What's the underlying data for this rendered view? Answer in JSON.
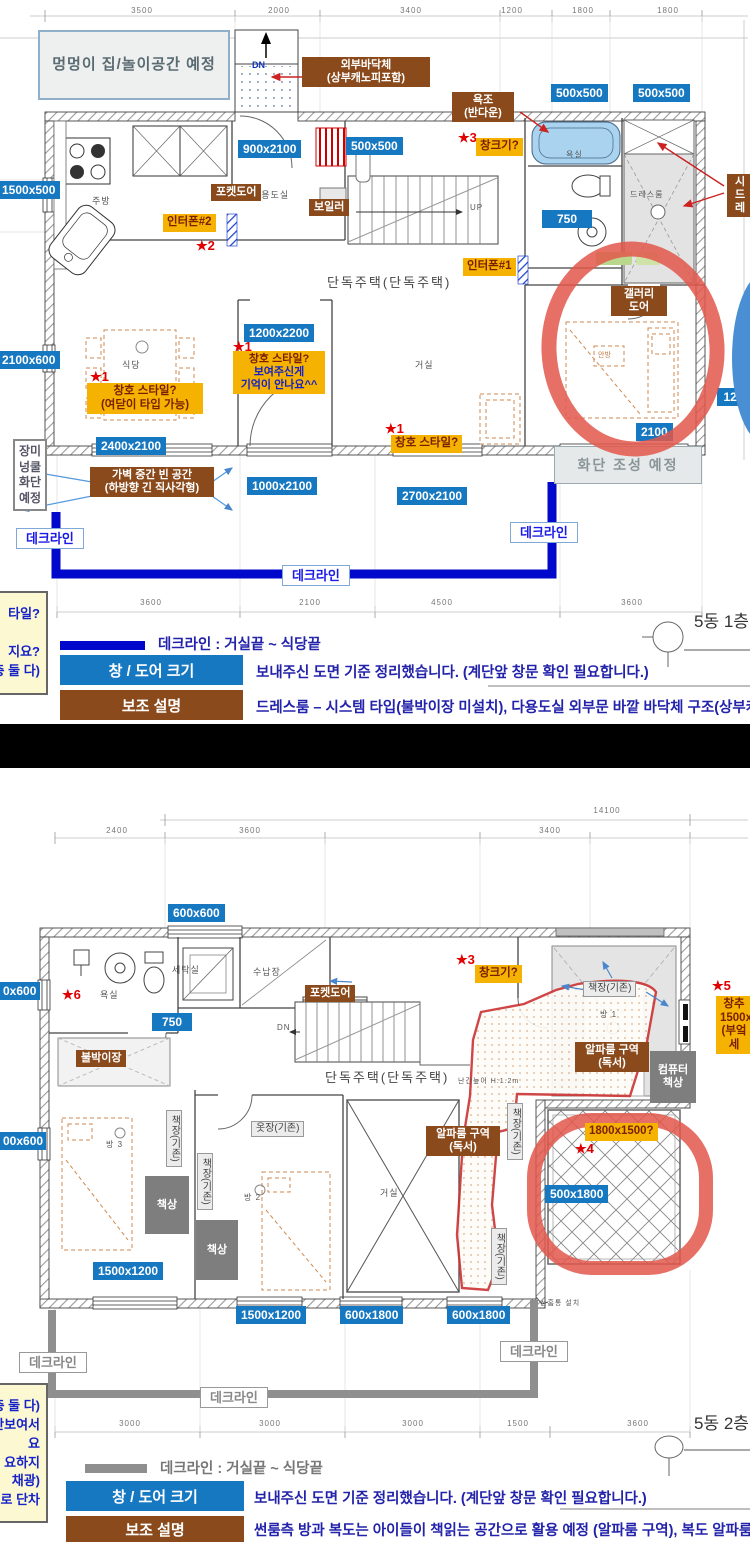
{
  "plan1": {
    "labels": [
      {
        "n": "dim-text",
        "c": "dtext",
        "t": "3500",
        "x": 120,
        "y": 6
      },
      {
        "n": "dim-text",
        "c": "dtext",
        "t": "2000",
        "x": 257,
        "y": 6
      },
      {
        "n": "dim-text",
        "c": "dtext",
        "t": "3400",
        "x": 389,
        "y": 6
      },
      {
        "n": "dim-text",
        "c": "dtext",
        "t": "1200",
        "x": 490,
        "y": 6
      },
      {
        "n": "dim-text",
        "c": "dtext",
        "t": "1800",
        "x": 561,
        "y": 6
      },
      {
        "n": "dim-text",
        "c": "dtext",
        "t": "1800",
        "x": 646,
        "y": 6
      },
      {
        "n": "dim-text",
        "c": "dtext",
        "t": "3600",
        "x": 129,
        "y": 598
      },
      {
        "n": "dim-text",
        "c": "dtext",
        "t": "2100",
        "x": 288,
        "y": 598
      },
      {
        "n": "dim-text",
        "c": "dtext",
        "t": "4500",
        "x": 420,
        "y": 598
      },
      {
        "n": "dim-text",
        "c": "dtext",
        "t": "3600",
        "x": 610,
        "y": 598
      },
      {
        "n": "dog-house-note",
        "c": "bignote",
        "t": "멍멍이 집/놀이공간 예정",
        "x": 38,
        "y": 30,
        "w": 192,
        "h": 70
      },
      {
        "n": "dn-text",
        "c": "bluetext",
        "t": "DN",
        "x": 252,
        "y": 60
      },
      {
        "n": "exterior-floor-note",
        "c": "brown",
        "t": "외부바닥체\n(상부캐노피포함)",
        "x": 302,
        "y": 57,
        "w": 128
      },
      {
        "n": "bathtub-note",
        "c": "brown",
        "t": "욕조\n(반다운)",
        "x": 452,
        "y": 92,
        "w": 62
      },
      {
        "n": "dim-chip",
        "c": "dim",
        "t": "500x500",
        "x": 551,
        "y": 84
      },
      {
        "n": "dim-chip",
        "c": "dim",
        "t": "500x500",
        "x": 633,
        "y": 84
      },
      {
        "n": "star-mark",
        "c": "star",
        "t": "★3",
        "x": 458,
        "y": 130
      },
      {
        "n": "window-size-question",
        "c": "yellow",
        "t": "창크기?",
        "x": 476,
        "y": 138
      },
      {
        "n": "dim-chip",
        "c": "dim",
        "t": "900x2100",
        "x": 238,
        "y": 140
      },
      {
        "n": "dim-chip",
        "c": "dim",
        "t": "500x500",
        "x": 346,
        "y": 137
      },
      {
        "n": "dim-chip",
        "c": "dim",
        "t": "1500x500",
        "x": -3,
        "y": 181
      },
      {
        "n": "room-text",
        "c": "ptext",
        "t": "다용도실",
        "x": 252,
        "y": 190
      },
      {
        "n": "room-text",
        "c": "ptext",
        "t": "주방",
        "x": 92,
        "y": 196
      },
      {
        "n": "room-text",
        "c": "ptext",
        "t": "욕실",
        "x": 566,
        "y": 150,
        "fs": 8
      },
      {
        "n": "room-text",
        "c": "ptext",
        "t": "드레스룸",
        "x": 630,
        "y": 190,
        "fs": 8
      },
      {
        "n": "pocket-door-note",
        "c": "brown",
        "t": "포켓도어",
        "x": 211,
        "y": 184
      },
      {
        "n": "boiler-note",
        "c": "brown",
        "t": "보일러",
        "x": 309,
        "y": 199
      },
      {
        "n": "system-dress-note",
        "c": "brown",
        "t": "시\n드레",
        "x": 727,
        "y": 174,
        "w": 26
      },
      {
        "n": "dim-chip",
        "c": "dim",
        "t": "750",
        "x": 542,
        "y": 210,
        "w": 50
      },
      {
        "n": "up-text",
        "c": "ptext",
        "t": "UP",
        "x": 470,
        "y": 203,
        "fs": 8
      },
      {
        "n": "interphone2-note",
        "c": "yellow",
        "t": "인터폰#2",
        "x": 163,
        "y": 214
      },
      {
        "n": "star-mark",
        "c": "star",
        "t": "★2",
        "x": 196,
        "y": 238
      },
      {
        "n": "interphone1-note",
        "c": "yellow",
        "t": "인터폰#1",
        "x": 463,
        "y": 258
      },
      {
        "n": "plan-title",
        "c": "ptext big",
        "t": "단독주택(단독주택)",
        "x": 327,
        "y": 275
      },
      {
        "n": "gallery-door-note",
        "c": "brown",
        "t": "갤러리\n도어",
        "x": 611,
        "y": 286,
        "w": 56
      },
      {
        "n": "dim-chip",
        "c": "dim",
        "t": "1200x2200",
        "x": 244,
        "y": 324
      },
      {
        "n": "star-mark",
        "c": "star",
        "t": "★1",
        "x": 233,
        "y": 339
      },
      {
        "n": "window-style-question",
        "c": "yellow-split",
        "t": "창호 스타일?\n보여주신게\n기억이 안나요^^",
        "x": 233,
        "y": 351,
        "w": 92
      },
      {
        "n": "room-text",
        "c": "ptext",
        "t": "식당",
        "x": 122,
        "y": 360
      },
      {
        "n": "room-text",
        "c": "ptext",
        "t": "거실",
        "x": 415,
        "y": 360
      },
      {
        "n": "room-text",
        "c": "otext",
        "t": "안방",
        "x": 598,
        "y": 352
      },
      {
        "n": "star-mark",
        "c": "star",
        "t": "★1",
        "x": 90,
        "y": 369
      },
      {
        "n": "window-style-question",
        "c": "yellow",
        "t": "창호 스타일?\n(여닫이 타입 가능)",
        "x": 87,
        "y": 383,
        "w": 116
      },
      {
        "n": "dim-chip",
        "c": "dim",
        "t": "2100x600",
        "x": -3,
        "y": 351
      },
      {
        "n": "dim-chip",
        "c": "dim",
        "t": "120",
        "x": 717,
        "y": 388,
        "w": 33
      },
      {
        "n": "star-mark",
        "c": "star",
        "t": "★1",
        "x": 385,
        "y": 421
      },
      {
        "n": "window-style-question",
        "c": "yellow",
        "t": "창호 스타일?",
        "x": 391,
        "y": 435
      },
      {
        "n": "dim-chip",
        "c": "dim",
        "t": "2100",
        "x": 636,
        "y": 423
      },
      {
        "n": "dim-chip",
        "c": "dim",
        "t": "2400x2100",
        "x": 96,
        "y": 437
      },
      {
        "n": "flowerbed-note",
        "c": "graynote",
        "t": "화단 조성 예정",
        "x": 554,
        "y": 446,
        "w": 148,
        "h": 38
      },
      {
        "n": "rose-bed-note",
        "c": "vnote",
        "t": "장미\n넝쿨\n화단\n예정",
        "x": 13,
        "y": 439,
        "w": 34
      },
      {
        "n": "partition-gap-note",
        "c": "brown",
        "t": "가벽 중간 빈 공간\n(하방향 긴 직사각형)",
        "x": 90,
        "y": 467,
        "w": 124
      },
      {
        "n": "dim-chip",
        "c": "dim",
        "t": "1000x2100",
        "x": 247,
        "y": 477
      },
      {
        "n": "dim-chip",
        "c": "dim",
        "t": "2700x2100",
        "x": 397,
        "y": 487
      },
      {
        "n": "deck-line-label",
        "c": "deckb",
        "t": "데크라인",
        "x": 16,
        "y": 528
      },
      {
        "n": "deck-line-label",
        "c": "deckb",
        "t": "데크라인",
        "x": 510,
        "y": 522
      },
      {
        "n": "deck-line-label",
        "c": "deckb",
        "t": "데크라인",
        "x": 282,
        "y": 565
      },
      {
        "n": "side-note",
        "c": "sidenote",
        "t": "타일?\n\n지요?\n층 둘 다)",
        "x": -128,
        "y": 591,
        "w": 176,
        "h": 104
      },
      {
        "n": "floor-tag",
        "c": "ftag",
        "t": "5동 1층",
        "x": 694,
        "y": 612
      }
    ],
    "legend": {
      "deck": "데크라인 : 거실끝 ~ 식당끝",
      "size_title": "창 / 도어 크기",
      "size_text": "보내주신 도면 기준 정리했습니다. (계단앞 창문 확인 필요합니다.)",
      "aux_title": "보조 설명",
      "aux_text": "드레스룸 – 시스템 타입(불박이장 미설치), 다용도실 외부문 바깥 바닥체 구조(상부캐노피 포함)"
    }
  },
  "plan2": {
    "labels": [
      {
        "n": "dim-text",
        "c": "dtext",
        "t": "14100",
        "x": 585,
        "y": 806
      },
      {
        "n": "dim-text",
        "c": "dtext",
        "t": "2400",
        "x": 95,
        "y": 826
      },
      {
        "n": "dim-text",
        "c": "dtext",
        "t": "3600",
        "x": 228,
        "y": 826
      },
      {
        "n": "dim-text",
        "c": "dtext",
        "t": "3400",
        "x": 528,
        "y": 826
      },
      {
        "n": "dim-chip",
        "c": "dim",
        "t": "600x600",
        "x": 168,
        "y": 904
      },
      {
        "n": "dim-chip",
        "c": "dim",
        "t": "0x600",
        "x": -2,
        "y": 982,
        "w": 42
      },
      {
        "n": "star-mark",
        "c": "star",
        "t": "★6",
        "x": 62,
        "y": 987
      },
      {
        "n": "room-text",
        "c": "ptext",
        "t": "욕실",
        "x": 100,
        "y": 990
      },
      {
        "n": "room-text",
        "c": "ptext",
        "t": "세탁실",
        "x": 172,
        "y": 965
      },
      {
        "n": "room-text",
        "c": "ptext",
        "t": "수납장",
        "x": 253,
        "y": 967
      },
      {
        "n": "star-mark",
        "c": "star",
        "t": "★3",
        "x": 456,
        "y": 952
      },
      {
        "n": "window-size-question",
        "c": "yellow",
        "t": "창크기?",
        "x": 475,
        "y": 965
      },
      {
        "n": "pocket-door-note",
        "c": "brown",
        "t": "포켓도어",
        "x": 305,
        "y": 985
      },
      {
        "n": "bookshelf-label",
        "c": "glabel",
        "t": "책장(기존)",
        "x": 583,
        "y": 981
      },
      {
        "n": "star-mark",
        "c": "star",
        "t": "★5",
        "x": 712,
        "y": 978
      },
      {
        "n": "window-add-note",
        "c": "yellow",
        "t": "창추\n1500x\n(부엌세",
        "x": 716,
        "y": 996,
        "w": 36
      },
      {
        "n": "dim-chip",
        "c": "dim",
        "t": "750",
        "x": 152,
        "y": 1013,
        "w": 40
      },
      {
        "n": "dn-text",
        "c": "ptext",
        "t": "DN",
        "x": 277,
        "y": 1023,
        "fs": 8
      },
      {
        "n": "room-text",
        "c": "ptext",
        "t": "방 1",
        "x": 600,
        "y": 1010,
        "fs": 8
      },
      {
        "n": "alpha-room-note",
        "c": "brown",
        "t": "알파룸 구역\n(독서)",
        "x": 575,
        "y": 1042,
        "w": 74
      },
      {
        "n": "builtin-closet-note",
        "c": "brown",
        "t": "불박이장",
        "x": 76,
        "y": 1050
      },
      {
        "n": "computer-desk-box",
        "c": "gbox",
        "t": "컴퓨터\n책상",
        "x": 650,
        "y": 1051,
        "w": 46,
        "h": 52
      },
      {
        "n": "plan-title",
        "c": "ptext big",
        "t": "단독주택(단독주택)",
        "x": 325,
        "y": 1070
      },
      {
        "n": "railing-text",
        "c": "ptext",
        "t": "난간높이 H:1.2m",
        "x": 458,
        "y": 1078,
        "fs": 7
      },
      {
        "n": "bookshelf-label",
        "c": "glabel vert",
        "t": "책장(기존)",
        "x": 507,
        "y": 1103
      },
      {
        "n": "bookshelf-label",
        "c": "glabel vert",
        "t": "책장(기존)",
        "x": 166,
        "y": 1110
      },
      {
        "n": "wardrobe-label",
        "c": "glabel",
        "t": "옷장(기존)",
        "x": 251,
        "y": 1121
      },
      {
        "n": "star-mark",
        "c": "star",
        "t": "★4",
        "x": 575,
        "y": 1141,
        "z": 6
      },
      {
        "n": "window-size-question",
        "c": "yellow",
        "t": "1800x1500?",
        "x": 585,
        "y": 1123,
        "z": 6
      },
      {
        "n": "alpha-room-note",
        "c": "brown",
        "t": "알파룸 구역\n(독서)",
        "x": 426,
        "y": 1126,
        "w": 74
      },
      {
        "n": "dim-chip",
        "c": "dim",
        "t": "00x600",
        "x": -2,
        "y": 1132,
        "w": 48
      },
      {
        "n": "room-text",
        "c": "ptext",
        "t": "방 3",
        "x": 106,
        "y": 1140,
        "fs": 8
      },
      {
        "n": "bookshelf-label",
        "c": "glabel vert",
        "t": "책장(기존)",
        "x": 197,
        "y": 1153
      },
      {
        "n": "desk-box",
        "c": "gbox",
        "t": "책상",
        "x": 145,
        "y": 1176,
        "w": 44,
        "h": 58
      },
      {
        "n": "dim-chip",
        "c": "dim",
        "t": "500x1800",
        "x": 545,
        "y": 1185,
        "z": 6
      },
      {
        "n": "room-text",
        "c": "ptext",
        "t": "방 2",
        "x": 244,
        "y": 1193,
        "fs": 8
      },
      {
        "n": "room-text",
        "c": "ptext",
        "t": "거실",
        "x": 380,
        "y": 1188
      },
      {
        "n": "desk-box",
        "c": "gbox",
        "t": "책상",
        "x": 196,
        "y": 1220,
        "w": 42,
        "h": 60
      },
      {
        "n": "bookshelf-label",
        "c": "glabel vert",
        "t": "책장(기존)",
        "x": 491,
        "y": 1228
      },
      {
        "n": "dim-chip",
        "c": "dim",
        "t": "1500x1200",
        "x": 93,
        "y": 1262
      },
      {
        "n": "downspout-text",
        "c": "ptext",
        "t": "선홈통 설치",
        "x": 540,
        "y": 1300,
        "fs": 7
      },
      {
        "n": "dim-chip",
        "c": "dim",
        "t": "1500x1200",
        "x": 236,
        "y": 1306
      },
      {
        "n": "dim-chip",
        "c": "dim",
        "t": "600x1800",
        "x": 340,
        "y": 1306
      },
      {
        "n": "dim-chip",
        "c": "dim",
        "t": "600x1800",
        "x": 447,
        "y": 1306
      },
      {
        "n": "deck-line-label",
        "c": "deckg",
        "t": "데크라인",
        "x": 19,
        "y": 1352
      },
      {
        "n": "deck-line-label",
        "c": "deckg",
        "t": "데크라인",
        "x": 500,
        "y": 1341
      },
      {
        "n": "deck-line-label",
        "c": "deckg",
        "t": "데크라인",
        "x": 200,
        "y": 1387
      },
      {
        "n": "side-note",
        "c": "sidenote",
        "t": "층 둘 다)\n안보여서\n요\n요하지\n채광)\n로 단차",
        "x": -130,
        "y": 1383,
        "w": 178,
        "h": 140
      },
      {
        "n": "dim-text",
        "c": "dtext",
        "t": "3000",
        "x": 108,
        "y": 1419
      },
      {
        "n": "dim-text",
        "c": "dtext",
        "t": "3000",
        "x": 248,
        "y": 1419
      },
      {
        "n": "dim-text",
        "c": "dtext",
        "t": "3000",
        "x": 391,
        "y": 1419
      },
      {
        "n": "dim-text",
        "c": "dtext",
        "t": "1500",
        "x": 496,
        "y": 1419
      },
      {
        "n": "dim-text",
        "c": "dtext",
        "t": "3600",
        "x": 616,
        "y": 1419
      },
      {
        "n": "floor-tag",
        "c": "ftag",
        "t": "5동 2층",
        "x": 694,
        "y": 1414
      }
    ],
    "legend": {
      "deck": "데크라인 : 거실끝 ~ 식당끝",
      "size_title": "창 / 도어 크기",
      "size_text": "보내주신 도면 기준 정리했습니다. (계단앞 창문 확인 필요합니다.)",
      "aux_title": "보조 설명",
      "aux_text": "썬룸측 방과 복도는 아이들이 책읽는 공간으로 활용 예정 (알파룸 구역), 복도 알파룸 구역에 전등 배치시"
    }
  }
}
